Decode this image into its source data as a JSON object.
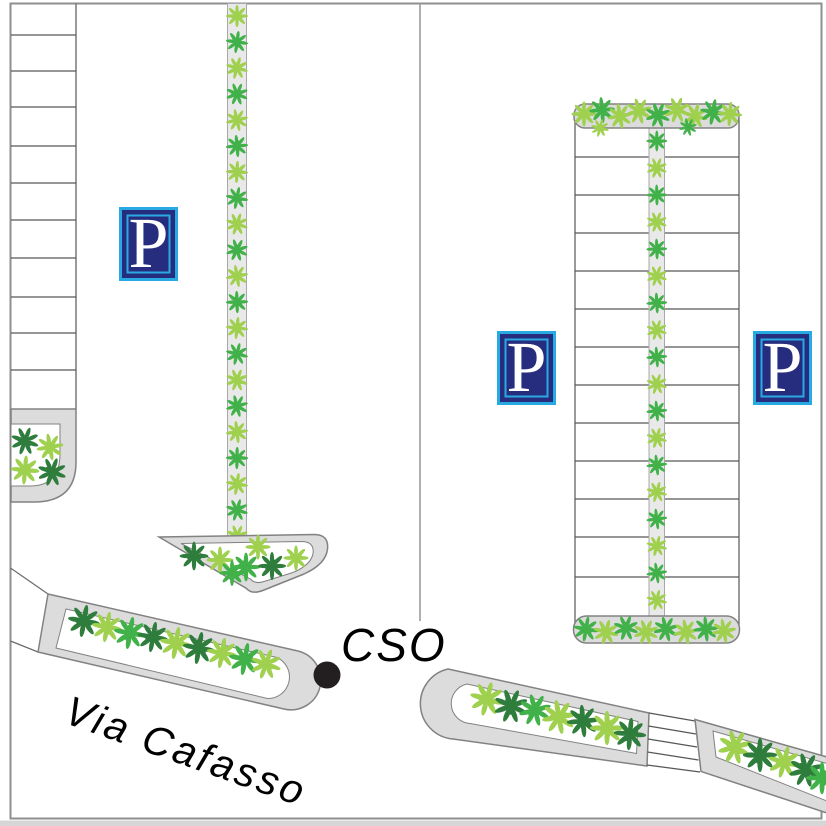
{
  "map": {
    "labels": {
      "road": "Via Cafasso",
      "poi": "CSO"
    },
    "parking_sign_letter": "P",
    "parking_sign_count": 3
  },
  "colors": {
    "surface_white": "#ffffff",
    "map_border": "#8f8f8f",
    "divider": "#9c9c9c",
    "stall_line": "#575757",
    "block_edge": "#6e6e6e",
    "island_fill": "#dcdcdc",
    "island_stroke": "#828282",
    "hedge_bg": "#e9e9e9",
    "hedge_stroke": "#a8a8a8",
    "leaf_light": "#9fd04e",
    "leaf_medium": "#41b149",
    "leaf_dark": "#2f7d3c",
    "sign_blue": "#29a9e1",
    "sign_navy": "#262d7e",
    "sign_letter": "#ffffff",
    "poi_dot": "#231f20",
    "label_text": "#000000",
    "bottom_edge": "#d6d6d6"
  }
}
